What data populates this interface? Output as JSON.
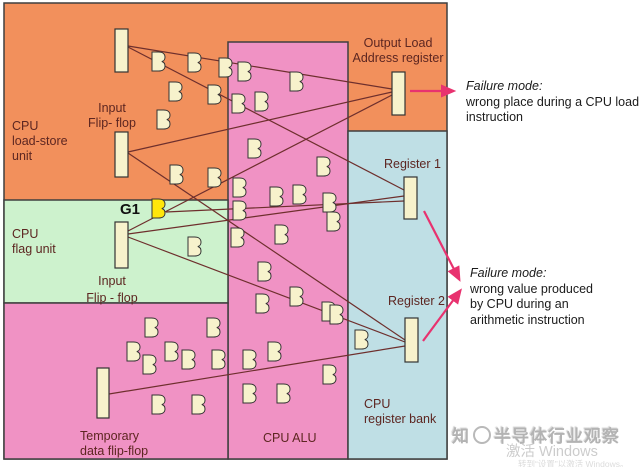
{
  "colors": {
    "orange": "#F2905C",
    "pink": "#F092C4",
    "green": "#CDF2CD",
    "blue": "#BFDFE5",
    "gate": "#F7F2CC",
    "gate_struck": "#FFE60A",
    "wire": "#6E2F2D",
    "arrow": "#E8326F",
    "border": "#3F3F3F",
    "label": "#5D2621"
  },
  "labels": {
    "load_store_unit": "CPU\nload-store\nunit",
    "input_ff_top": "Input\nFlip- flop",
    "g1": "G1",
    "flag_unit": "CPU\nflag unit",
    "input_ff_flag": "Input\nFlip - flop",
    "temp_ff": "Temporary\ndata flip-flop",
    "alu": "CPU ALU",
    "output_load_register": "Output Load\nAddress register",
    "register1": "Register 1",
    "register2": "Register 2",
    "register_bank": "CPU\nregister bank"
  },
  "failures": {
    "load": {
      "title": "Failure mode:",
      "body": "wrong place during a CPU load\ninstruction"
    },
    "arith": {
      "title": "Failure mode:",
      "body": "wrong value produced\nby CPU during an\narithmetic instruction"
    }
  },
  "watermark": {
    "prefix": "知",
    "brand": "半导体行业观察",
    "activate": "激活 Windows",
    "hint": "转到“设置”以激活 Windows。"
  },
  "diagram": {
    "regions": [
      {
        "name": "cpu-load-store-unit-region",
        "x": 4,
        "y": 3,
        "w": 443,
        "h": 456,
        "color": "orange"
      },
      {
        "name": "cpu-alu-region",
        "x": 228,
        "y": 42,
        "w": 120,
        "h": 417,
        "color": "pink"
      },
      {
        "name": "cpu-flag-unit-region",
        "x": 4,
        "y": 200,
        "w": 224,
        "h": 103,
        "color": "green"
      },
      {
        "name": "alu-lower-left-region",
        "x": 4,
        "y": 303,
        "w": 224,
        "h": 156,
        "color": "pink"
      },
      {
        "name": "cpu-register-bank-region",
        "x": 348,
        "y": 131,
        "w": 99,
        "h": 328,
        "color": "blue"
      }
    ],
    "flipflops": [
      {
        "name": "load-store-output-flipflop",
        "x": 115,
        "y": 29,
        "w": 13,
        "h": 43
      },
      {
        "name": "load-store-input-flipflop",
        "x": 115,
        "y": 132,
        "w": 13,
        "h": 45
      },
      {
        "name": "flag-unit-input-flipflop",
        "x": 115,
        "y": 222,
        "w": 13,
        "h": 46
      },
      {
        "name": "temporary-data-flipflop",
        "x": 97,
        "y": 368,
        "w": 12,
        "h": 50
      },
      {
        "name": "output-load-address-register",
        "x": 392,
        "y": 72,
        "w": 13,
        "h": 43
      },
      {
        "name": "register-1",
        "x": 404,
        "y": 177,
        "w": 13,
        "h": 42
      },
      {
        "name": "register-2",
        "x": 405,
        "y": 318,
        "w": 13,
        "h": 44
      }
    ],
    "gates": [
      [
        152,
        52
      ],
      [
        188,
        53
      ],
      [
        219,
        58
      ],
      [
        238,
        62
      ],
      [
        290,
        72
      ],
      [
        169,
        82
      ],
      [
        208,
        85
      ],
      [
        232,
        94
      ],
      [
        255,
        92
      ],
      [
        157,
        110
      ],
      [
        248,
        139
      ],
      [
        317,
        157
      ],
      [
        170,
        165
      ],
      [
        208,
        168
      ],
      [
        233,
        178
      ],
      [
        270,
        187
      ],
      [
        293,
        185
      ],
      [
        323,
        193
      ],
      [
        233,
        201
      ],
      [
        188,
        237
      ],
      [
        275,
        225
      ],
      [
        327,
        212
      ],
      [
        231,
        228
      ],
      [
        258,
        262
      ],
      [
        290,
        287
      ],
      [
        256,
        294
      ],
      [
        322,
        302
      ],
      [
        145,
        318
      ],
      [
        207,
        318
      ],
      [
        127,
        342
      ],
      [
        165,
        342
      ],
      [
        143,
        355
      ],
      [
        182,
        350
      ],
      [
        212,
        350
      ],
      [
        243,
        350
      ],
      [
        268,
        342
      ],
      [
        243,
        384
      ],
      [
        277,
        384
      ],
      [
        152,
        395
      ],
      [
        192,
        395
      ],
      [
        330,
        305
      ],
      [
        355,
        330
      ],
      [
        323,
        365
      ]
    ],
    "struck_gate": [
      152,
      199
    ],
    "wires": [
      [
        128,
        46,
        392,
        89
      ],
      [
        128,
        47,
        404,
        190
      ],
      [
        128,
        152,
        392,
        92
      ],
      [
        128,
        153,
        405,
        340
      ],
      [
        128,
        234,
        404,
        196
      ],
      [
        166,
        212,
        404,
        201
      ],
      [
        128,
        231,
        392,
        95
      ],
      [
        128,
        237,
        405,
        342
      ],
      [
        109,
        394,
        405,
        346
      ]
    ],
    "arrows": [
      [
        410,
        91,
        453,
        91
      ],
      [
        424,
        211,
        459,
        279
      ],
      [
        423,
        341,
        460,
        291
      ]
    ]
  }
}
